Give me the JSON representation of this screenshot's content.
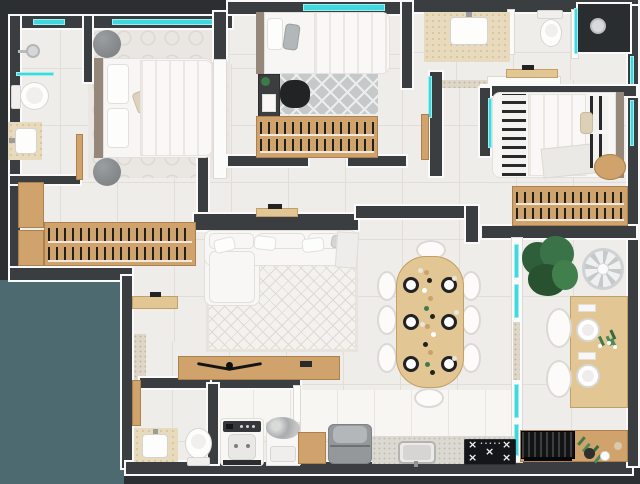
{
  "meta": {
    "title": "3D apartment floor plan render, top-down view",
    "canvas_width": 640,
    "canvas_height": 484
  },
  "palette": {
    "exterior": "#2c2f31",
    "courtyard_teal": "#4d6a71",
    "wall_core": "#3a3e41",
    "wall_trim": "#fafafa",
    "glass_cyan": "#3fd8de",
    "floor_tile": "#efedea",
    "grout": "#e1ded8",
    "wood": "#cfa36b",
    "wood_light": "#e2c694",
    "granite": "#ddd6c9",
    "beige_counter": "#e8dbbd",
    "white_textile": "#f8f7f5",
    "gray_rug": "#c6c9ca",
    "pouf_gray": "#85888b",
    "clothes_dark": "#1e1f20",
    "plant_green": "#35693f",
    "appliance_black": "#141619",
    "appliance_gray": "#94989b"
  },
  "icons": {
    "burner": "×",
    "knobs": "•••••"
  },
  "rooms": [
    {
      "id": "bathroom-1",
      "label": "ensuite bathroom",
      "furniture": [
        "shower-head",
        "glass-partition",
        "toilet",
        "beige-vanity-sink",
        "wood-door",
        "window"
      ]
    },
    {
      "id": "bedroom-1",
      "label": "master bedroom",
      "furniture": [
        "double-bed",
        "headboard",
        "pillows",
        "gray-pouf-top",
        "gray-pouf-bottom",
        "patterned-rug",
        "window"
      ]
    },
    {
      "id": "walk-in-closet",
      "label": "walk-in closet",
      "furniture": [
        "wood-cabinets",
        "clothes-racks"
      ]
    },
    {
      "id": "bedroom-2",
      "label": "bedroom 2",
      "furniture": [
        "single-bed",
        "desk",
        "black-office-chair",
        "diamond-rug",
        "clothes-wardrobe",
        "window"
      ]
    },
    {
      "id": "bathroom-2",
      "label": "bathroom 2",
      "furniture": [
        "beige-vanity-sink",
        "toilet",
        "shower-recess",
        "glass-screen",
        "granite-threshold"
      ]
    },
    {
      "id": "bedroom-3",
      "label": "bedroom 3",
      "furniture": [
        "single-bed",
        "striped-runner",
        "striped-pillows",
        "wood-stool",
        "clothes-wardrobe",
        "glass-door"
      ]
    },
    {
      "id": "hallway",
      "label": "hallway",
      "furniture": [
        "wall-console-left",
        "wall-console-right",
        "entry-sideboard",
        "granite-entry-strip"
      ]
    },
    {
      "id": "living-room",
      "label": "living room",
      "furniture": [
        "corner-sofa",
        "cushions",
        "area-rug",
        "tv-sideboard",
        "wing-sculpture"
      ]
    },
    {
      "id": "dining-room",
      "label": "dining room",
      "furniture": [
        "oval-wood-table",
        "eight-white-chairs",
        "six-place-settings",
        "centerpiece"
      ]
    },
    {
      "id": "balcony",
      "label": "gourmet balcony",
      "furniture": [
        "potted-plant",
        "floor-fan",
        "wood-dining-counter",
        "two-armchairs",
        "plates",
        "flower-vase",
        "barbecue-grill",
        "glass-partition-wall"
      ]
    },
    {
      "id": "bathroom-3",
      "label": "guest bathroom",
      "furniture": [
        "beige-vanity-sink",
        "toilet",
        "wood-door"
      ]
    },
    {
      "id": "laundry",
      "label": "laundry room",
      "furniture": [
        "washing-machine",
        "laundry-tub",
        "clothes-pile"
      ]
    },
    {
      "id": "kitchen",
      "label": "kitchen",
      "furniture": [
        "wood-cabinet",
        "refrigerator",
        "granite-counter",
        "inset-sink",
        "gas-cooktop"
      ]
    }
  ]
}
